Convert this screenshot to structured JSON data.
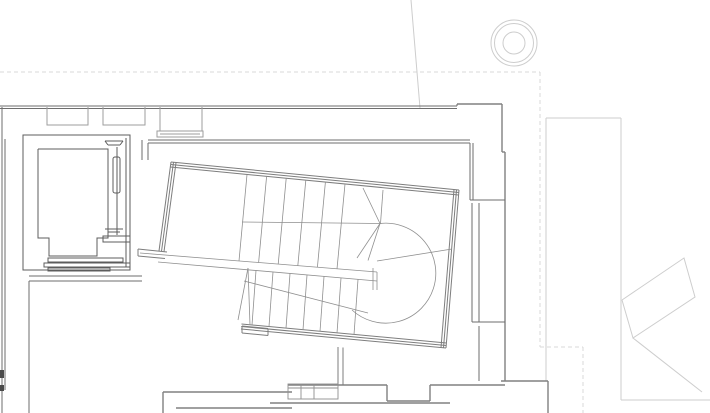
{
  "meta": {
    "drawing_type": "architectural-floor-plan-detail",
    "content": [
      "stair-enclosure",
      "winder-stair",
      "elevator-shaft",
      "perimeter-walls",
      "column-symbol",
      "context-building"
    ],
    "visible_text": []
  },
  "canvas": {
    "width": 710,
    "height": 413,
    "background": "#ffffff"
  },
  "palette": {
    "background": "#ffffff",
    "dashed_reference": "#d9d9d9",
    "context_light": "#cdcdcd",
    "outer_wall": "#808080",
    "inner_wall": "#6e6e6e",
    "elevator": "#5c5c5c",
    "window_niche": "#9e9e9e",
    "stair_wall": "#7d7d7d",
    "stair_detail": "#8f8f8f",
    "section_mark": "#4a4a4a"
  },
  "layers": [
    {
      "name": "dashed-reference-lines",
      "stroke": "#d9d9d9",
      "width": 1,
      "dash": "4 3",
      "segments": [
        [
          0,
          72,
          540,
          72
        ],
        [
          540,
          72,
          540,
          347
        ],
        [
          540,
          347,
          583,
          347
        ],
        [
          583,
          347,
          583,
          413
        ]
      ]
    },
    {
      "name": "context-building-light",
      "stroke": "#cdcdcd",
      "width": 1,
      "segments": [
        [
          411,
          0,
          420,
          108
        ],
        [
          546,
          118,
          621,
          118
        ],
        [
          546,
          118,
          546,
          381
        ],
        [
          621,
          118,
          621,
          400
        ],
        [
          621,
          400,
          710,
          400
        ],
        [
          633,
          338,
          702,
          392
        ]
      ],
      "polylines": [
        [
          [
            622,
            300
          ],
          [
            684,
            258
          ],
          [
            695,
            297
          ],
          [
            633,
            338
          ],
          [
            622,
            300
          ]
        ]
      ],
      "circles": [
        [
          514,
          43,
          23
        ],
        [
          514,
          43,
          19.5
        ],
        [
          514,
          43,
          11
        ]
      ]
    },
    {
      "name": "outer-walls",
      "stroke": "#808080",
      "width": 1.4,
      "segments": [
        [
          457,
          104,
          502,
          104
        ],
        [
          502,
          104,
          502,
          152
        ],
        [
          502,
          152,
          505,
          152
        ],
        [
          505,
          152,
          505,
          381
        ],
        [
          501,
          381,
          548,
          381
        ],
        [
          548,
          381,
          548,
          413
        ],
        [
          288,
          385,
          387,
          385
        ],
        [
          387,
          385,
          387,
          401
        ],
        [
          387,
          401,
          430,
          401
        ],
        [
          430,
          385,
          430,
          401
        ],
        [
          430,
          385,
          505,
          385
        ],
        [
          163,
          392,
          292,
          392
        ],
        [
          163,
          392,
          163,
          413
        ],
        [
          176,
          408,
          292,
          408
        ],
        [
          270,
          403,
          450,
          403
        ]
      ]
    },
    {
      "name": "inner-walls",
      "stroke": "#6e6e6e",
      "width": 1,
      "segments": [
        [
          0,
          106,
          457,
          106
        ],
        [
          0,
          108.5,
          457,
          108.5
        ],
        [
          457,
          104,
          457,
          106
        ],
        [
          2,
          107,
          2,
          413
        ],
        [
          5,
          139,
          5,
          390
        ],
        [
          148,
          140,
          470,
          140
        ],
        [
          148,
          143,
          470,
          143
        ],
        [
          142,
          140,
          142,
          160
        ],
        [
          148,
          143,
          148,
          160
        ],
        [
          470,
          143,
          470,
          200
        ],
        [
          473,
          143,
          473,
          200
        ],
        [
          470,
          200,
          505,
          200
        ],
        [
          472,
          203,
          472,
          322
        ],
        [
          479,
          203,
          479,
          322
        ],
        [
          472,
          322,
          505,
          322
        ],
        [
          479,
          326,
          479,
          381
        ],
        [
          29,
          276,
          142,
          276
        ],
        [
          29,
          281,
          142,
          281
        ],
        [
          29,
          281,
          29,
          413
        ]
      ],
      "fillColor": "#4a4a4a",
      "fills": [
        [
          0,
          370,
          4,
          8
        ],
        [
          0,
          385,
          4,
          6
        ]
      ]
    },
    {
      "name": "window-niches",
      "stroke": "#9e9e9e",
      "width": 1,
      "polylines": [
        [
          [
            47,
            107
          ],
          [
            47,
            125
          ],
          [
            88,
            125
          ],
          [
            88,
            107
          ]
        ],
        [
          [
            103,
            107
          ],
          [
            103,
            125
          ],
          [
            145,
            125
          ],
          [
            145,
            107
          ]
        ],
        [
          [
            160,
            107
          ],
          [
            160,
            131
          ],
          [
            202,
            131
          ],
          [
            202,
            107
          ]
        ]
      ],
      "rects": [
        [
          157,
          131,
          46,
          6,
          0
        ]
      ],
      "segments": [
        [
          160,
          134,
          200,
          134
        ]
      ]
    },
    {
      "name": "elevator-shaft",
      "stroke": "#5c5c5c",
      "width": 1,
      "rects": [
        [
          23,
          135,
          107,
          135,
          0
        ],
        [
          113,
          157,
          7,
          36,
          2
        ],
        [
          103,
          236,
          27,
          6,
          0
        ],
        [
          48,
          258,
          75,
          4,
          0
        ],
        [
          44,
          263,
          86,
          4,
          0
        ],
        [
          48,
          268,
          62,
          3,
          0
        ]
      ],
      "segments": [
        [
          126,
          138,
          126,
          267
        ],
        [
          117,
          147,
          117,
          235
        ],
        [
          105,
          141,
          123,
          141
        ],
        [
          108,
          145,
          120,
          145
        ],
        [
          105,
          141,
          108,
          145
        ],
        [
          123,
          141,
          120,
          145
        ],
        [
          105,
          229,
          123,
          229
        ],
        [
          108,
          232,
          120,
          232
        ]
      ],
      "polylines": [
        [
          [
            38,
            149
          ],
          [
            108,
            149
          ],
          [
            108,
            238
          ],
          [
            97,
            238
          ],
          [
            97,
            256
          ],
          [
            49,
            256
          ],
          [
            49,
            238
          ],
          [
            38,
            238
          ],
          [
            38,
            149
          ]
        ]
      ]
    },
    {
      "name": "stair-enclosure-walls",
      "stroke": "#7d7d7d",
      "width": 1,
      "segments": [
        [
          171,
          162,
          459,
          190
        ],
        [
          170.8,
          164.5,
          458.8,
          192.5
        ],
        [
          170.5,
          167,
          458.5,
          195
        ],
        [
          171,
          162,
          159,
          251
        ],
        [
          173.5,
          162.3,
          161.5,
          251.3
        ],
        [
          176,
          162.7,
          164,
          251.7
        ],
        [
          459,
          190,
          446,
          348
        ],
        [
          456.5,
          189.8,
          443.5,
          347.8
        ],
        [
          454,
          189.6,
          441,
          347.6
        ],
        [
          446,
          348,
          241,
          329
        ],
        [
          446.2,
          345.5,
          241.2,
          326.5
        ],
        [
          446.5,
          343,
          241.5,
          324
        ],
        [
          242,
          326,
          268,
          328.5
        ],
        [
          242,
          333,
          268,
          335.5
        ],
        [
          242,
          326,
          242,
          333
        ],
        [
          268,
          328.5,
          268,
          335.5
        ],
        [
          138,
          249,
          167,
          252
        ],
        [
          138,
          256,
          165,
          258.5
        ],
        [
          138,
          249,
          138,
          256
        ],
        [
          338,
          347,
          338,
          385
        ],
        [
          343,
          347.5,
          343,
          385
        ]
      ]
    },
    {
      "name": "stair-treads-and-rails",
      "stroke": "#8f8f8f",
      "width": 0.8,
      "segments": [
        [
          242,
          222,
          381,
          223.5
        ],
        [
          140,
          253,
          377,
          272
        ],
        [
          158,
          262,
          377,
          281
        ],
        [
          373,
          268,
          373,
          290
        ],
        [
          377,
          272,
          377,
          290
        ],
        [
          247,
          174.5,
          239,
          261
        ],
        [
          266.6,
          176.4,
          258.6,
          262.6
        ],
        [
          286.2,
          178.3,
          278.2,
          264.2
        ],
        [
          305.8,
          180.2,
          297.8,
          265.8
        ],
        [
          325.4,
          182.1,
          317.4,
          267.3
        ],
        [
          345,
          184,
          337,
          268.9
        ],
        [
          363,
          188,
          380,
          223.5
        ],
        [
          383,
          190,
          380.5,
          223.5
        ],
        [
          380,
          223.5,
          357,
          258
        ],
        [
          380,
          223.5,
          368,
          260.5
        ],
        [
          256,
          270.5,
          252,
          325
        ],
        [
          273,
          272,
          269,
          326.5
        ],
        [
          290,
          273.5,
          286,
          328.2
        ],
        [
          307,
          275,
          303,
          329.8
        ],
        [
          324,
          276.5,
          320,
          331.4
        ],
        [
          341,
          278,
          337,
          333
        ],
        [
          358,
          279.5,
          354,
          334.6
        ],
        [
          248,
          268,
          238,
          320
        ],
        [
          248,
          268,
          250,
          325
        ],
        [
          244,
          281,
          368,
          313
        ],
        [
          377,
          261,
          452,
          249
        ]
      ],
      "paths": [
        "M 380 223.5 A 50 50 0 1 1 352 310"
      ]
    },
    {
      "name": "threshold-detail",
      "stroke": "#8f8f8f",
      "width": 0.9,
      "rects": [
        [
          288,
          384,
          50,
          15,
          0
        ]
      ],
      "segments": [
        [
          288,
          388,
          338,
          388
        ],
        [
          301,
          384,
          301,
          399
        ],
        [
          314,
          384,
          314,
          399
        ]
      ]
    }
  ]
}
